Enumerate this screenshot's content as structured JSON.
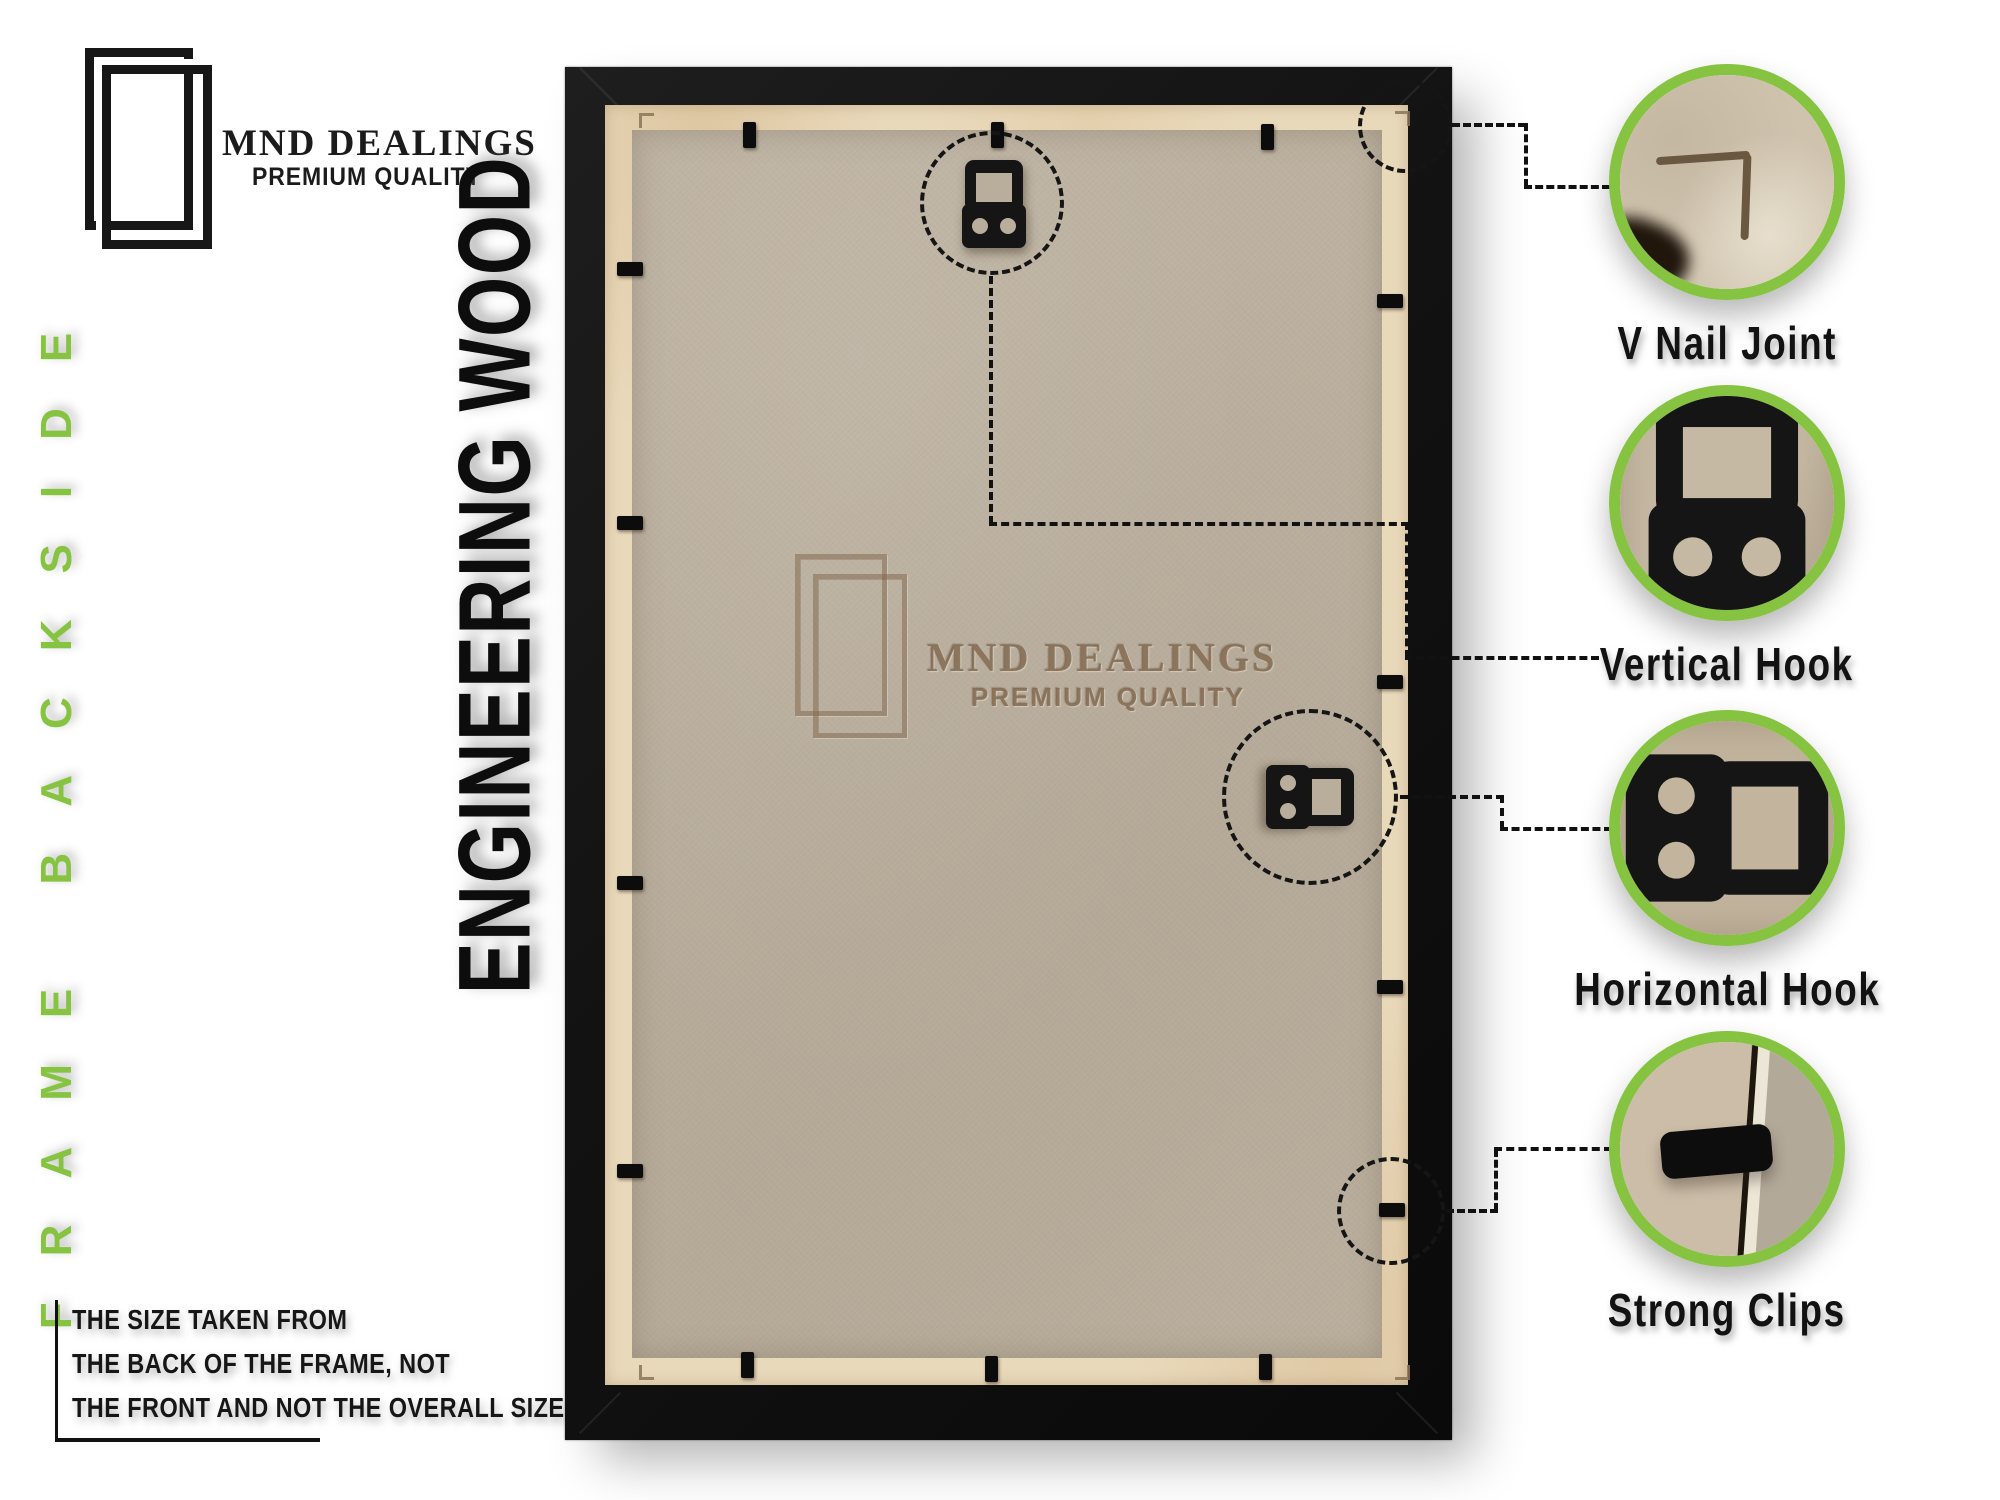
{
  "brand": {
    "name": "MND DEALINGS",
    "tagline": "PREMIUM QUALITY"
  },
  "labels": {
    "side": "FRAME BACKSIDE",
    "material": "ENGINEERING WOOD"
  },
  "watermark": {
    "name": "MND DEALINGS",
    "tagline": "PREMIUM QUALITY"
  },
  "callouts": [
    {
      "id": "v-nail-joint",
      "label": "V Nail Joint"
    },
    {
      "id": "vertical-hook",
      "label": "Vertical Hook"
    },
    {
      "id": "horizontal-hook",
      "label": "Horizontal Hook"
    },
    {
      "id": "strong-clips",
      "label": "Strong Clips"
    }
  ],
  "note": {
    "lines": [
      "THE SIZE TAKEN FROM",
      "THE BACK OF THE FRAME, NOT",
      "THE FRONT AND NOT THE OVERALL SIZE."
    ]
  },
  "colors": {
    "accent_green": "#85c340",
    "frame_black": "#141414",
    "board_tan": "#bcb1a0",
    "wood_strip": "#e9d9bb",
    "watermark_brown": "#7d6248",
    "annotation_black": "#111111"
  }
}
